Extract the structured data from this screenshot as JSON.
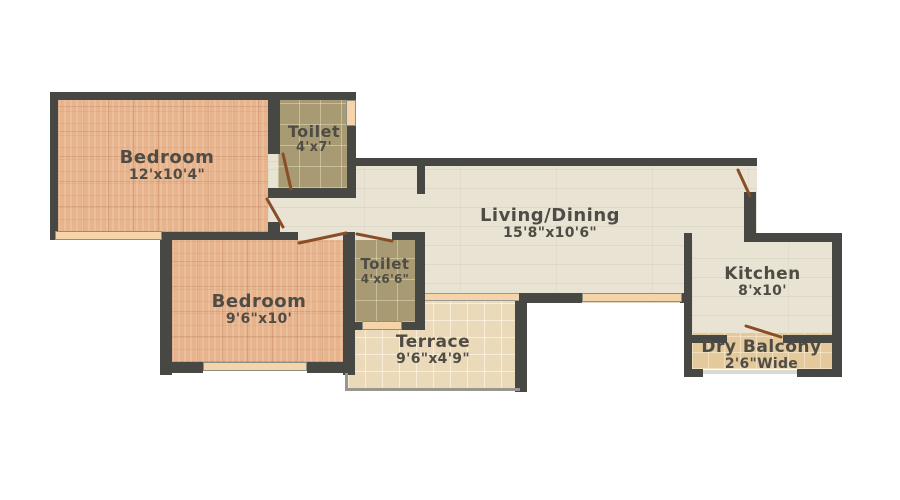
{
  "plan": {
    "title": "2 BHK Floor Plan",
    "rooms": [
      {
        "id": "bedroom-1",
        "name": "Bedroom",
        "dimensions": "12'x10'4\""
      },
      {
        "id": "toilet-1",
        "name": "Toilet",
        "dimensions": "4'x7'"
      },
      {
        "id": "living-dining",
        "name": "Living/Dining",
        "dimensions": "15'8\"x10'6\""
      },
      {
        "id": "bedroom-2",
        "name": "Bedroom",
        "dimensions": "9'6\"x10'"
      },
      {
        "id": "toilet-2",
        "name": "Toilet",
        "dimensions": "4'x6'6\""
      },
      {
        "id": "terrace",
        "name": "Terrace",
        "dimensions": "9'6\"x4'9\""
      },
      {
        "id": "kitchen",
        "name": "Kitchen",
        "dimensions": "8'x10'"
      },
      {
        "id": "dry-balcony",
        "name": "Dry Balcony",
        "dimensions": "2'6\"Wide"
      }
    ],
    "colors": {
      "background": "#ffffff",
      "wall": "#474743",
      "bedroom_floor": "#e8b48e",
      "toilet_floor": "#a89b73",
      "living_floor": "#e9e3d4",
      "terrace_floor": "#ebdaba",
      "dry_balcony_floor": "#e3c99c",
      "window_marker": "#f4d4a8",
      "door_swing": "#8a4e26",
      "label_text": "#4f4c45"
    }
  }
}
